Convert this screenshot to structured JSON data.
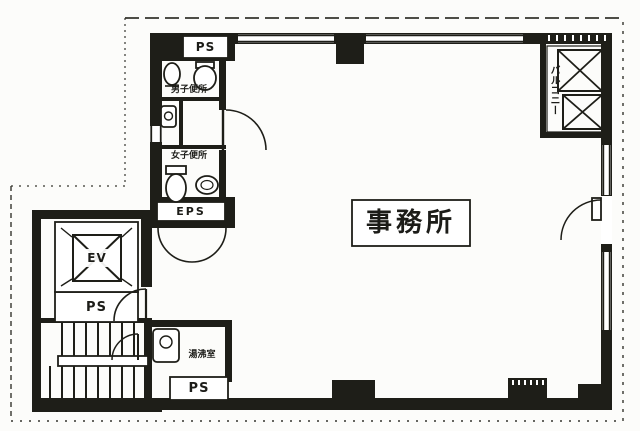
{
  "plan": {
    "labels": {
      "ps_top": "PS",
      "mens_toilet": "男子便所",
      "womens_toilet": "女子便所",
      "eps": "EPS",
      "elevator": "EV",
      "ps_elevator": "PS",
      "kitchenette": "湯沸室",
      "ps_bottom": "PS",
      "office": "事務所",
      "balcony": "バルコニー"
    },
    "colors": {
      "wall": "#1e1e18",
      "paper": "#fcfcfa",
      "ink": "#1c1c18",
      "boundary": "#35352e"
    }
  }
}
